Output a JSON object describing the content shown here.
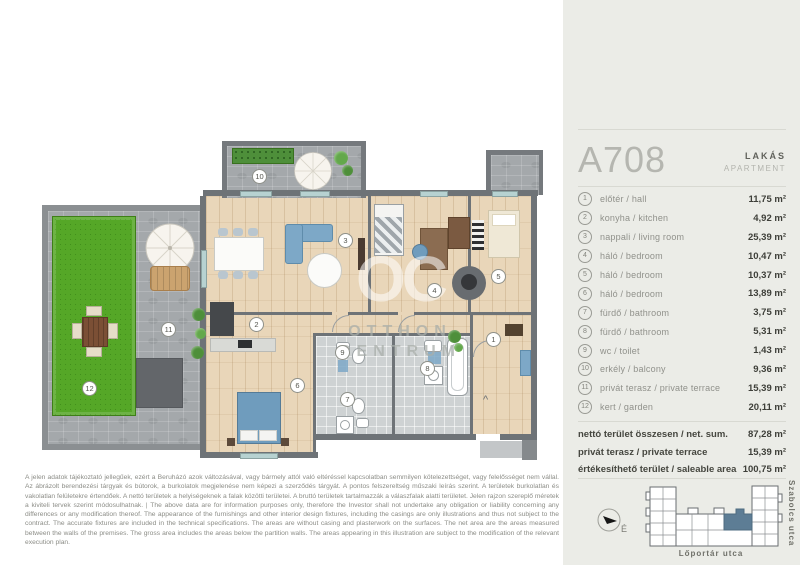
{
  "sidebar": {
    "unit_id": "A708",
    "unit_type_hu": "LAKÁS",
    "unit_type_en": "APARTMENT",
    "rooms": [
      {
        "num": "1",
        "label": "előtér / hall",
        "area": "11,75 m²"
      },
      {
        "num": "2",
        "label": "konyha / kitchen",
        "area": "4,92 m²"
      },
      {
        "num": "3",
        "label": "nappali / living room",
        "area": "25,39 m²"
      },
      {
        "num": "4",
        "label": "háló / bedroom",
        "area": "10,47 m²"
      },
      {
        "num": "5",
        "label": "háló / bedroom",
        "area": "10,37 m²"
      },
      {
        "num": "6",
        "label": "háló / bedroom",
        "area": "13,89 m²"
      },
      {
        "num": "7",
        "label": "fürdő / bathroom",
        "area": "3,75 m²"
      },
      {
        "num": "8",
        "label": "fürdő / bathroom",
        "area": "5,31 m²"
      },
      {
        "num": "9",
        "label": "wc / toilet",
        "area": "1,43 m²"
      },
      {
        "num": "10",
        "label": "erkély / balcony",
        "area": "9,36 m²"
      },
      {
        "num": "11",
        "label": "privát terasz / private terrace",
        "area": "15,39 m²"
      },
      {
        "num": "12",
        "label": "kert / garden",
        "area": "20,11 m²"
      }
    ],
    "totals": [
      {
        "label": "nettó terület összesen / net. sum.",
        "value": "87,28 m²"
      },
      {
        "label": "privát terasz / private terrace",
        "value": "15,39 m²"
      },
      {
        "label": "értékesíthető terület / saleable area",
        "value": "100,75 m²"
      }
    ],
    "compass_label": "É",
    "street_bottom": "Lőportár utca",
    "street_right": "Szabolcs utca",
    "highlight_color": "#5d7d95"
  },
  "plan": {
    "watermark": {
      "monogram": "OC",
      "line1": "OTTHON",
      "line2": "CENTRUM"
    },
    "badges": [
      "1",
      "2",
      "3",
      "4",
      "5",
      "6",
      "7",
      "8",
      "9",
      "10",
      "11",
      "12"
    ],
    "entrance_marker": "^"
  },
  "disclaimer": {
    "text": "A jelen adatok tájékoztató jellegűek, ezért a Beruházó azok változásával, vagy bármely attól való eltéréssel kapcsolatban semmilyen kötelezettséget, vagy felelősséget nem vállal. Az ábrázolt berendezési tárgyak és bútorok, a burkolatok megjelenése nem képezi a szerződés tárgyát. A pontos felszereltség műszaki leírás szerint. A területek burkolatlan és vakolatlan felületekre értendőek. A nettó területek a helyiségeknek a falak közötti területei. A bruttó területek tartalmazzák a válaszfalak alatti területet. Jelen rajzon szereplő méretek a kiviteli tervek szerint módosulhatnak. | The above data are for information purposes only, therefore the Investor shall not undertake any obligation or liability concerning any differences or any modification thereof. The appearance of the furnishings and other interior design fixtures, including the casings are only illustrations and thus not subject to the contract. The accurate fixtures are included in the technical specifications. The areas are without casing and plasterwork on the surfaces. The net area are the areas measured between the walls of the premises. The gross area includes the areas below the partition walls. The areas appearing in this illustration are subject to the modification of the relevant execution plan."
  }
}
